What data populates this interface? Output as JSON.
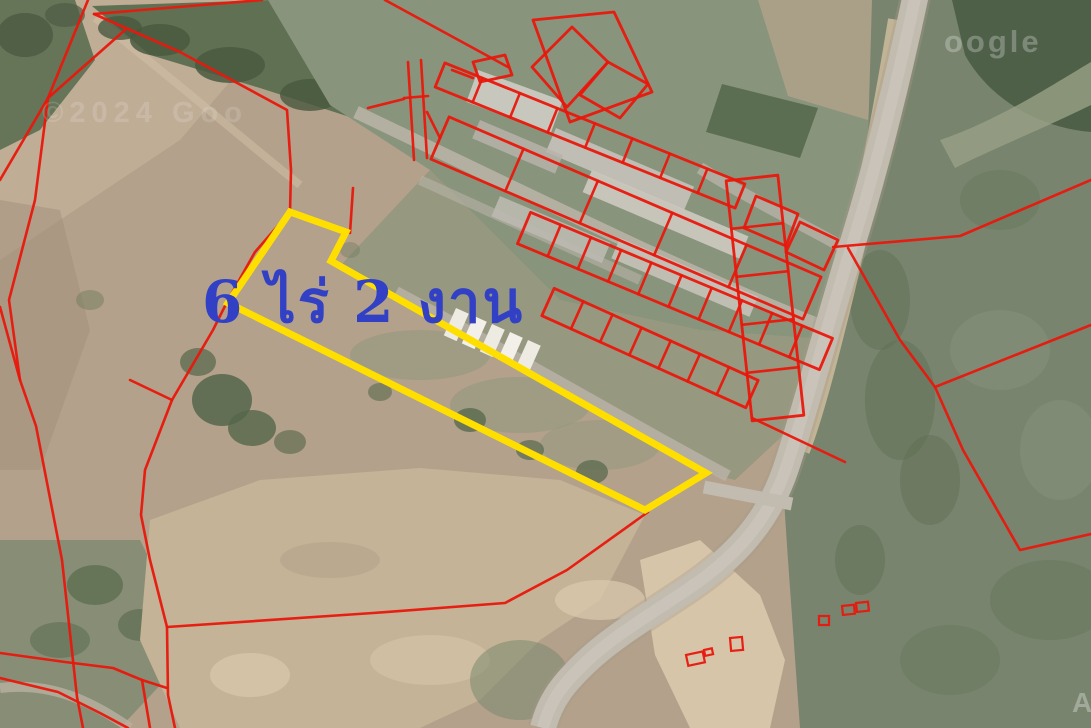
{
  "area_label": {
    "text": "6 ไร่ 2 งาน",
    "color": "#3240c6",
    "x": 202,
    "y": 322,
    "font_size": 58
  },
  "watermarks": {
    "top_left": "©2024 Goo",
    "top_right": "oogle",
    "bottom_right": "A",
    "color": "#ffffff"
  },
  "overlay": {
    "red": "#e9170c",
    "yellow": "#ffdf00",
    "yellow_polygon": "290,212 346,232 331,261 706,473 645,510 228,303",
    "red_polylines": [
      "88,0 48,98 0,180",
      "125,30 48,98",
      "48,98 35,200 9,300 20,380 36,426 62,560 77,697 83,728",
      "0,307 20,380",
      "94,14 262,0",
      "94,14 180,52 287,110 291,170 290,212 255,252 228,300 213,330 172,400 145,470 141,515 150,560 167,627 168,695 175,728",
      "130,380 172,400",
      "0,653 65,662 113,668 142,680 167,688",
      "142,680 150,728",
      "0,678 58,692 100,713 128,728",
      "167,627 373,613 505,603 567,570 648,512",
      "833,247 960,236 1091,180",
      "848,248 900,340 935,387 963,450 1020,550 1091,534",
      "935,387 1091,325",
      "368,108 404,99",
      "408,62 414,160",
      "421,60 427,158",
      "404,98 428,96",
      "427,112 440,138",
      "353,188 350,233",
      "385,0 508,67",
      "452,70 473,78",
      "752,418 845,462"
    ],
    "red_polygons": [
      "756,196 798,214 786,246 744,228",
      "800,222 838,240 824,270 786,252",
      "572,27 608,62 567,107 532,67",
      "608,62 648,84 620,118 580,95",
      "533,20 614,12 652,92 570,122",
      "473,62 505,55 512,75 480,82"
    ],
    "ladders": [
      {
        "x1": 440,
        "y1": 75,
        "x2": 740,
        "y2": 196,
        "hw": 13,
        "rungs": 8
      },
      {
        "x1": 440,
        "y1": 138,
        "x2": 812,
        "y2": 298,
        "hw": 23,
        "rungs": 5
      },
      {
        "x1": 524,
        "y1": 228,
        "x2": 826,
        "y2": 354,
        "hw": 17,
        "rungs": 10
      },
      {
        "x1": 548,
        "y1": 302,
        "x2": 752,
        "y2": 394,
        "hw": 15,
        "rungs": 7
      },
      {
        "x1": 752,
        "y1": 178,
        "x2": 778,
        "y2": 418,
        "hw": 26,
        "rungs": 5
      }
    ],
    "vehicles": [
      {
        "x": 686,
        "y": 655,
        "w": 17,
        "h": 11,
        "rot": -12
      },
      {
        "x": 704,
        "y": 650,
        "w": 8,
        "h": 6,
        "rot": -12
      },
      {
        "x": 730,
        "y": 638,
        "w": 12,
        "h": 13,
        "rot": -5
      },
      {
        "x": 819,
        "y": 616,
        "w": 10,
        "h": 9,
        "rot": 0
      },
      {
        "x": 842,
        "y": 606,
        "w": 12,
        "h": 9,
        "rot": -6
      },
      {
        "x": 856,
        "y": 603,
        "w": 12,
        "h": 9,
        "rot": -6
      }
    ]
  },
  "terrain_colors": {
    "field_tan": "#b3a18b",
    "dirt_pale": "#c5b397",
    "road_gray": "#c2bbaf",
    "water_green": "#78846e",
    "pond_dark": "#4f6049",
    "tree_dark": "#4d5c44"
  }
}
